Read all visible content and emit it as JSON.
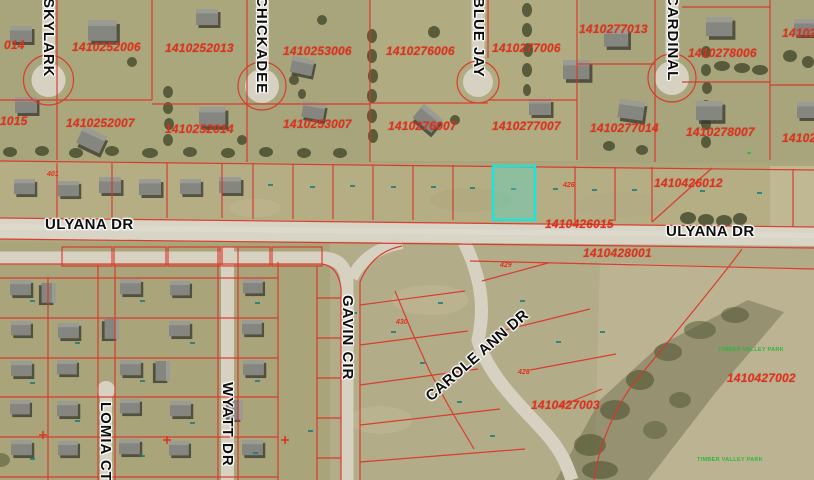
{
  "app": {
    "type": "gis-parcel-map-view"
  },
  "colors": {
    "parcel_boundary": "#dc3428",
    "parcel_text": "#e2301c",
    "highlight_stroke": "#10e8e2",
    "highlight_fill": "rgba(64,224,208,0.33)",
    "road": "#d6d1c1",
    "street_text": "#0d0d0d",
    "subdivision_text": "#2db83d"
  },
  "selected_parcel": {
    "x": 493,
    "y": 166,
    "width": 42,
    "height": 54
  },
  "parcel_labels": [
    {
      "text": "014",
      "x": 4,
      "y": 38
    },
    {
      "text": "1410252006",
      "x": 72,
      "y": 40
    },
    {
      "text": "1410252013",
      "x": 165,
      "y": 41
    },
    {
      "text": "1410253006",
      "x": 283,
      "y": 44
    },
    {
      "text": "1410276006",
      "x": 386,
      "y": 44
    },
    {
      "text": "1410277006",
      "x": 492,
      "y": 41
    },
    {
      "text": "1410277013",
      "x": 579,
      "y": 22
    },
    {
      "text": "1410278006",
      "x": 688,
      "y": 46
    },
    {
      "text": "14102",
      "x": 782,
      "y": 26
    },
    {
      "text": "1015",
      "x": 0,
      "y": 114
    },
    {
      "text": "1410252007",
      "x": 66,
      "y": 116
    },
    {
      "text": "1410252014",
      "x": 165,
      "y": 122
    },
    {
      "text": "1410253007",
      "x": 283,
      "y": 117
    },
    {
      "text": "1410276007",
      "x": 388,
      "y": 119
    },
    {
      "text": "1410277007",
      "x": 492,
      "y": 119
    },
    {
      "text": "1410277014",
      "x": 590,
      "y": 121
    },
    {
      "text": "1410278007",
      "x": 686,
      "y": 125
    },
    {
      "text": "14102",
      "x": 782,
      "y": 131
    },
    {
      "text": "1410426012",
      "x": 654,
      "y": 176
    },
    {
      "text": "1410426015",
      "x": 545,
      "y": 217
    },
    {
      "text": "1410428001",
      "x": 583,
      "y": 246
    },
    {
      "text": "1410427003",
      "x": 531,
      "y": 398
    },
    {
      "text": "1410427002",
      "x": 727,
      "y": 371
    }
  ],
  "small_parcel_labels": [
    {
      "text": "401",
      "x": 47,
      "y": 171
    },
    {
      "text": "426",
      "x": 563,
      "y": 182
    },
    {
      "text": "429",
      "x": 500,
      "y": 262
    },
    {
      "text": "430",
      "x": 396,
      "y": 319
    },
    {
      "text": "428",
      "x": 518,
      "y": 369
    }
  ],
  "street_labels": [
    {
      "text": "SKYLARK",
      "x": 40,
      "y": -2,
      "dir": "v"
    },
    {
      "text": "CHICKADEE",
      "x": 253,
      "y": -4,
      "dir": "v"
    },
    {
      "text": "BLUE JAY",
      "x": 470,
      "y": -3,
      "dir": "v"
    },
    {
      "text": "CARDINAL",
      "x": 664,
      "y": -5,
      "dir": "v"
    },
    {
      "text": "ULYANA DR",
      "x": 45,
      "y": 216,
      "dir": "h"
    },
    {
      "text": "ULYANA DR",
      "x": 666,
      "y": 223,
      "dir": "h"
    },
    {
      "text": "GAVIN CIR",
      "x": 339,
      "y": 295,
      "dir": "v"
    },
    {
      "text": "CAROLE ANN DR",
      "x": 428,
      "y": 390,
      "dir": "d",
      "rot": -41
    },
    {
      "text": "WYATT DR",
      "x": 219,
      "y": 382,
      "dir": "v"
    },
    {
      "text": "LOMIA CT",
      "x": 97,
      "y": 402,
      "dir": "v"
    }
  ],
  "green_labels": [
    {
      "text": "TIMBER VALLEY PARK",
      "x": 718,
      "y": 347
    },
    {
      "text": "TIMBER VALLEY PARK",
      "x": 697,
      "y": 457
    }
  ]
}
